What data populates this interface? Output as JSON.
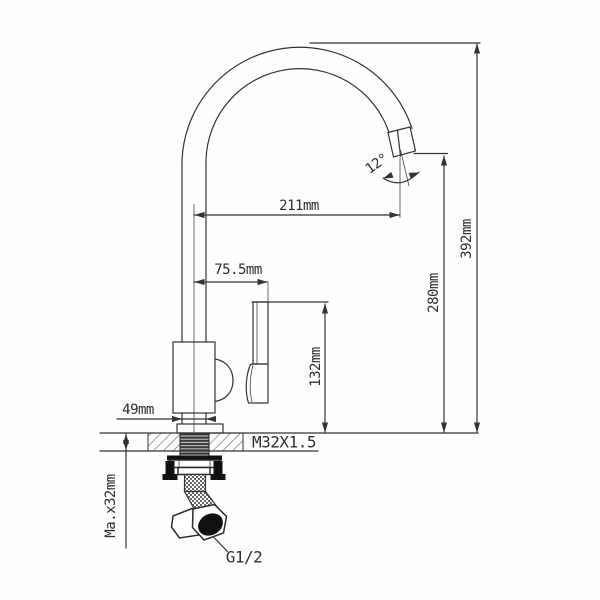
{
  "diagram": {
    "subject": "Kitchen faucet technical dimension drawing",
    "colors": {
      "line": "#333333",
      "background": "#ffffff",
      "dark_fill": "#111111"
    },
    "dimensions": {
      "spout_reach": "211mm",
      "handle_offset": "75.5mm",
      "handle_height": "132mm",
      "spout_height": "280mm",
      "overall_height": "392mm",
      "base_width": "49mm",
      "spout_angle": "12°",
      "mounting_thread": "M32X1.5",
      "max_deck_thickness": "Ma.x32mm",
      "hose_connection": "G1/2"
    }
  }
}
